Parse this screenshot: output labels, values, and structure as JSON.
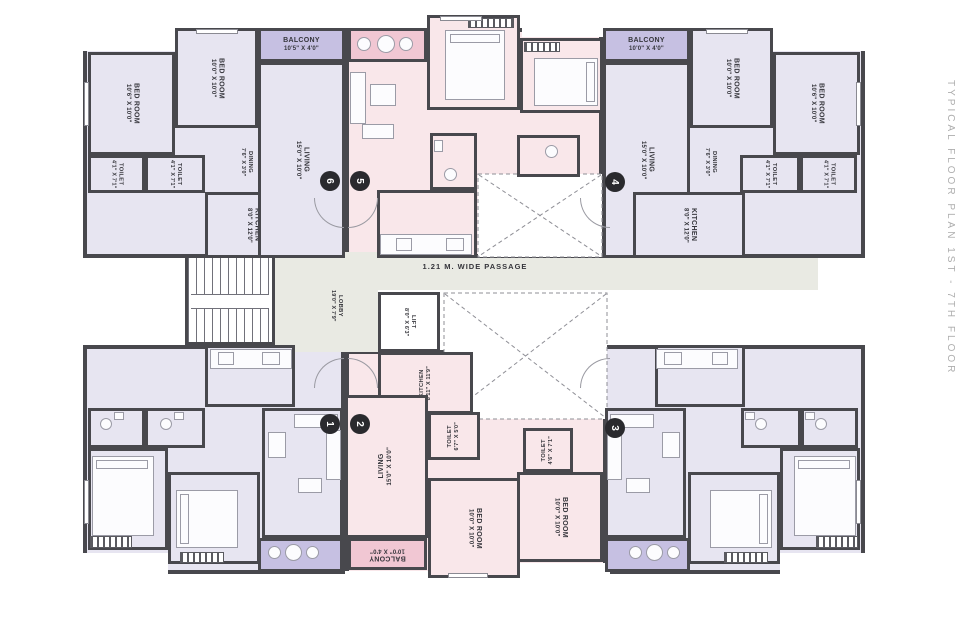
{
  "side_title": "TYPICAL FLOOR PLAN 1ST - 7TH FLOOR",
  "passage": {
    "label": "1.21 M. WIDE PASSAGE"
  },
  "lobby": {
    "name": "LOBBY",
    "dims": "19'0\" X 7'9\""
  },
  "lift": {
    "name": "LIFT",
    "dims": "8'0\" X 6'3\""
  },
  "markers": {
    "m1": "1",
    "m2": "2",
    "m3": "3",
    "m4": "4",
    "m5": "5",
    "m6": "6"
  },
  "units": {
    "unit6": {
      "rooms": [
        {
          "name": "BED ROOM",
          "dims": "10'6\" X 10'0\""
        },
        {
          "name": "BED ROOM",
          "dims": "10'0\" X 10'0\""
        },
        {
          "name": "TOILET",
          "dims": "4'1\" X 7'1\""
        },
        {
          "name": "TOILET",
          "dims": "4'1\" X 7'1\""
        },
        {
          "name": "DINING",
          "dims": "7'6\" X 3'0\""
        },
        {
          "name": "KITCHEN",
          "dims": "8'0\" X 12'0\""
        },
        {
          "name": "LIVING",
          "dims": "15'0\" X 10'0\""
        },
        {
          "name": "BALCONY",
          "dims": "10'5\" X 4'0\""
        }
      ]
    },
    "unit4": {
      "rooms": [
        {
          "name": "BALCONY",
          "dims": "10'0\" X 4'0\""
        },
        {
          "name": "LIVING",
          "dims": "15'0\" X 10'0\""
        },
        {
          "name": "BED ROOM",
          "dims": "10'0\" X 10'0\""
        },
        {
          "name": "BED ROOM",
          "dims": "10'6\" X 10'0\""
        },
        {
          "name": "DINING",
          "dims": "7'6\" X 3'0\""
        },
        {
          "name": "TOILET",
          "dims": "4'1\" X 7'1\""
        },
        {
          "name": "TOILET",
          "dims": "4'1\" X 7'1\""
        },
        {
          "name": "KITCHEN",
          "dims": "8'0\" X 12'0\""
        }
      ]
    },
    "unit2": {
      "rooms": [
        {
          "name": "KITCHEN",
          "dims": "8'11\" X 11'9\""
        },
        {
          "name": "TOILET",
          "dims": "6'7\" X 5'0\""
        },
        {
          "name": "TOILET",
          "dims": "4'6\" X 7'1\""
        },
        {
          "name": "LIVING",
          "dims": "15'0\" X 10'0\""
        },
        {
          "name": "BALCONY",
          "dims": "10'0\" X 4'0\""
        },
        {
          "name": "BED ROOM",
          "dims": "10'0\" X 10'0\""
        },
        {
          "name": "BED ROOM",
          "dims": "10'0\" X 10'0\""
        }
      ]
    }
  },
  "colors": {
    "wall": "#48484d",
    "room_lavender": "#e7e5f1",
    "balcony_lavender": "#c6c0e2",
    "room_pink": "#f9e7ea",
    "balcony_pink": "#f1c7d3",
    "service_gray": "#e9eae3",
    "marker_bg": "#2a2a2e"
  },
  "icons": {
    "duct-cross-icon": "dashed X ventilation shaft",
    "stair-icon": "staircase treads",
    "bed-icon": "double bed with pillow",
    "wardrobe-icon": "hatched wardrobe strip",
    "sofa-icon": "sofa block",
    "table-icon": "table block",
    "balcony-table-icon": "round table with two chairs",
    "wc-icon": "toilet fixture",
    "counter-icon": "kitchen counter with sink and stove",
    "window-icon": "window notch",
    "door-arc-icon": "door swing arc"
  }
}
